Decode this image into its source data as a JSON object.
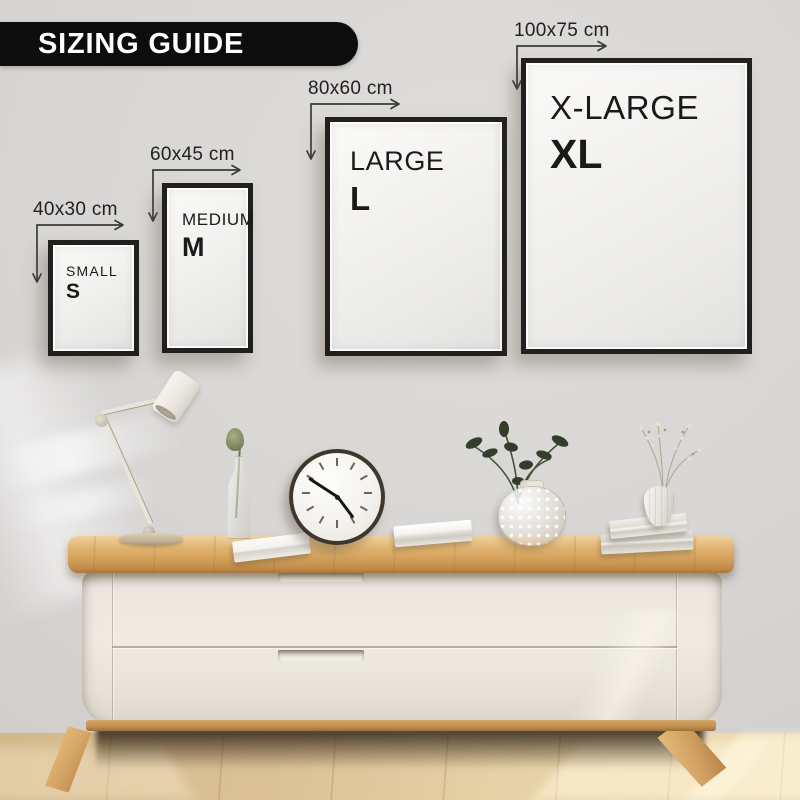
{
  "banner": {
    "title": "SIZING GUIDE"
  },
  "sizes": [
    {
      "name": "SMALL",
      "letter": "S",
      "dimensions": "40x30 cm"
    },
    {
      "name": "MEDIUM",
      "letter": "M",
      "dimensions": "60x45 cm"
    },
    {
      "name": "LARGE",
      "letter": "L",
      "dimensions": "80x60 cm"
    },
    {
      "name": "X-LARGE",
      "letter": "XL",
      "dimensions": "100x75 cm"
    }
  ],
  "colors": {
    "banner_bg": "#0d0d0d",
    "banner_text": "#ffffff",
    "frame_border": "#21201e",
    "label_text": "#222120",
    "wall": "#d8d6d4",
    "wood_top": "#d4a15c",
    "cabinet_body": "#efebe3",
    "floor": "#e0c59a"
  },
  "decor_items": [
    "desk-lamp",
    "bottle-vase-with-seed-head",
    "paper-stack",
    "wall-clock",
    "book",
    "bubble-glass-vase-with-foliage",
    "stacked-books",
    "white-vase-with-dried-flowers"
  ]
}
